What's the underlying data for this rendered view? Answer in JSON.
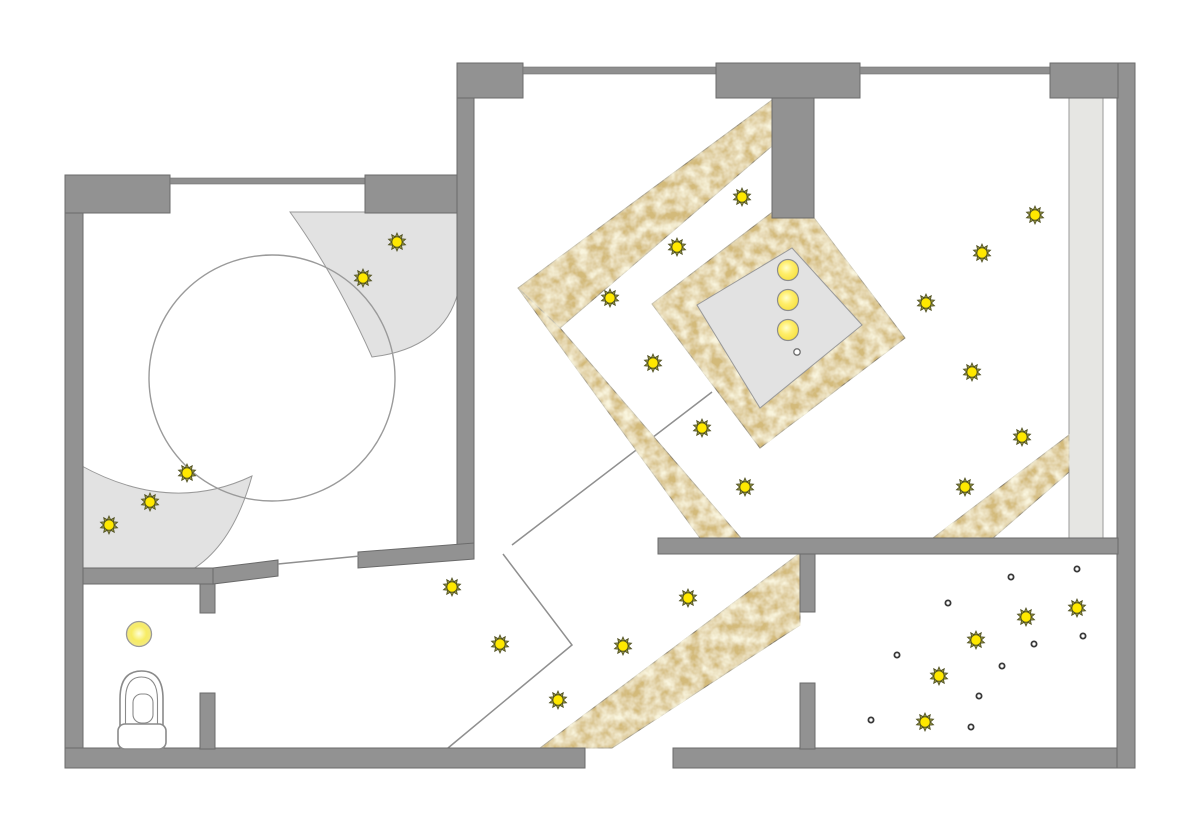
{
  "document": {
    "type": "ceiling-lighting-plan",
    "width": 1200,
    "height": 834
  },
  "palette": {
    "wall": "#929292",
    "wall_outline": "#6b6b6b",
    "zone_gray": "#e2e2e2",
    "zone_outline": "#9a9a9a",
    "gold_base": "#d3ba7a",
    "gold_light": "#f1e7bb",
    "gold_outline": "#8b8270",
    "sun_core": "#ffe800",
    "sun_ray": "#9a9a45",
    "sun_ray_outline": "#4f4f22",
    "line": "#8f8f8f",
    "dot": "#383838",
    "pendant_fill": "#ffee6b",
    "dome_fill": "#f7ec63"
  },
  "fixtures": {
    "spot_lights": {
      "top_left_room": [
        [
          397,
          242
        ],
        [
          363,
          278
        ],
        [
          187,
          473
        ],
        [
          150,
          502
        ],
        [
          109,
          525
        ]
      ],
      "center_room": [
        [
          742,
          197
        ],
        [
          677,
          247
        ],
        [
          610,
          298
        ],
        [
          653,
          363
        ],
        [
          702,
          428
        ],
        [
          745,
          487
        ]
      ],
      "right_room": [
        [
          1035,
          215
        ],
        [
          982,
          253
        ],
        [
          926,
          303
        ],
        [
          972,
          372
        ],
        [
          1022,
          437
        ],
        [
          965,
          487
        ]
      ],
      "hallway": [
        [
          452,
          587
        ],
        [
          500,
          644
        ],
        [
          558,
          700
        ],
        [
          623,
          646
        ],
        [
          688,
          598
        ]
      ],
      "bottom_right_room": [
        [
          1077,
          608
        ],
        [
          1026,
          617
        ],
        [
          976,
          640
        ],
        [
          939,
          676
        ],
        [
          925,
          722
        ]
      ]
    },
    "pendant_lights": [
      [
        788,
        270
      ],
      [
        788,
        300
      ],
      [
        788,
        330
      ]
    ],
    "pendant_marker": [
      797,
      352
    ],
    "dome_light": [
      139,
      634
    ],
    "fiber_dots": [
      [
        1077,
        569
      ],
      [
        1011,
        577
      ],
      [
        948,
        603
      ],
      [
        1083,
        636
      ],
      [
        1034,
        644
      ],
      [
        897,
        655
      ],
      [
        1002,
        666
      ],
      [
        979,
        696
      ],
      [
        871,
        720
      ],
      [
        971,
        727
      ]
    ]
  },
  "counts": {
    "spot_lights": 27,
    "pendant_lights": 3,
    "fiber_dots": 10,
    "dome_lights": 1
  }
}
